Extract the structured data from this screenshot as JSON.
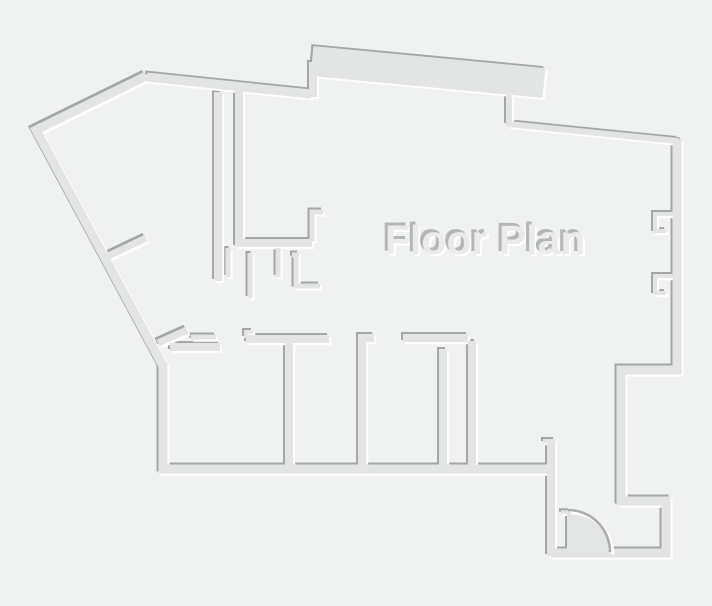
{
  "floorplan": {
    "title": "Floor Plan",
    "colors": {
      "background": "#f0f1f1",
      "wall_fill": "#e3e5e5",
      "wall_shadow": "#a4a7a6",
      "wall_highlight": "#fdfdfc",
      "text_fill": "#eaecec",
      "text_shadow": "#b4b7b6",
      "text_highlight": "#ffffff",
      "door_fill": "#e4e6e6",
      "door_arc_stroke": "#aaadac"
    },
    "walls": [
      {
        "name": "outer-left-upper-diagonal",
        "d": "M146,76 L36,130 L163,366",
        "w": 9
      },
      {
        "name": "outer-left-and-bottom",
        "d": "M163,362 L163,469 L553,469",
        "w": 9
      },
      {
        "name": "outer-top-shallow-diagonal",
        "d": "M147,77 L311,94",
        "w": 9
      },
      {
        "name": "top-band-riser",
        "d": "M313,97 L313,62",
        "w": 8
      },
      {
        "name": "top-band",
        "d": "M312,61 L544,83",
        "w": 30
      },
      {
        "name": "top-step",
        "d": "M509,95 L509,125",
        "w": 6
      },
      {
        "name": "top-right-diagonal",
        "d": "M508,124 L678,141",
        "w": 6
      },
      {
        "name": "right-and-entry-outer",
        "d": "M677,139 L677,370 L621,370 L621,501 L666,501 L666,553 L551,553",
        "w": 9
      },
      {
        "name": "entry-left-wall",
        "d": "M551,556 L551,439",
        "w": 8
      },
      {
        "name": "entry-left-hook",
        "d": "M543,441 L552,441",
        "w": 4
      },
      {
        "name": "window-bracket-upper",
        "d": "M675,214 L655,214 L655,231 L666,231",
        "w": 4
      },
      {
        "name": "window-bracket-lower",
        "d": "M675,276 L655,276 L655,293 L666,293",
        "w": 4
      },
      {
        "name": "hall-long-wall",
        "d": "M218,92 L218,281",
        "w": 8
      },
      {
        "name": "bath-wall",
        "d": "M239,90 L239,243 L312,243",
        "w": 8
      },
      {
        "name": "bath-stub-right",
        "d": "M312,241 L312,212 L323,212",
        "w": 5
      },
      {
        "name": "bath-jamb-1",
        "d": "M228,248 L228,277",
        "w": 5
      },
      {
        "name": "bath-jamb-2",
        "d": "M250,253 L250,298",
        "w": 5
      },
      {
        "name": "bath-jamb-3",
        "d": "M278,248 L278,277",
        "w": 5
      },
      {
        "name": "bath-fixture",
        "d": "M292,255 L299,255 M296,255 L296,286 L320,286",
        "w": 5
      },
      {
        "name": "left-stub-upper-diagonal",
        "d": "M104,258 L146,238",
        "w": 7
      },
      {
        "name": "left-stub-lower-diagonal",
        "d": "M158,343 L187,330",
        "w": 7
      },
      {
        "name": "left-stub-dash",
        "d": "M191,337 L216,337",
        "w": 5
      },
      {
        "name": "room1-top-wall",
        "d": "M170,347 L220,347",
        "w": 8
      },
      {
        "name": "door-header-1",
        "d": "M246,339 L329,339",
        "w": 8
      },
      {
        "name": "door-header-1-hook",
        "d": "M246,338 L246,332 L253,332",
        "w": 4
      },
      {
        "name": "room-divider-1",
        "d": "M289,341 L289,467",
        "w": 8
      },
      {
        "name": "door-header-2",
        "d": "M358,338 L374,338",
        "w": 8
      },
      {
        "name": "room-divider-2",
        "d": "M362,340 L362,467",
        "w": 8
      },
      {
        "name": "door-header-3",
        "d": "M403,338 L468,338",
        "w": 8
      },
      {
        "name": "room-divider-3",
        "d": "M443,349 L443,467",
        "w": 8
      },
      {
        "name": "rooms-right-wall",
        "d": "M472,341 L472,467",
        "w": 8
      },
      {
        "name": "door-frame-dash",
        "d": "M561,512 L570,512",
        "w": 3.5
      },
      {
        "name": "door-leaf",
        "d": "M569,511 L569,553",
        "w": 4
      }
    ],
    "door": {
      "wedge_d": "M569,511 A42,42 0 0 1 611,553 L569,553 Z",
      "arc_d": "M569,511 A42,42 0 0 1 611,553"
    },
    "canvas": {
      "width": 712,
      "height": 606
    }
  }
}
